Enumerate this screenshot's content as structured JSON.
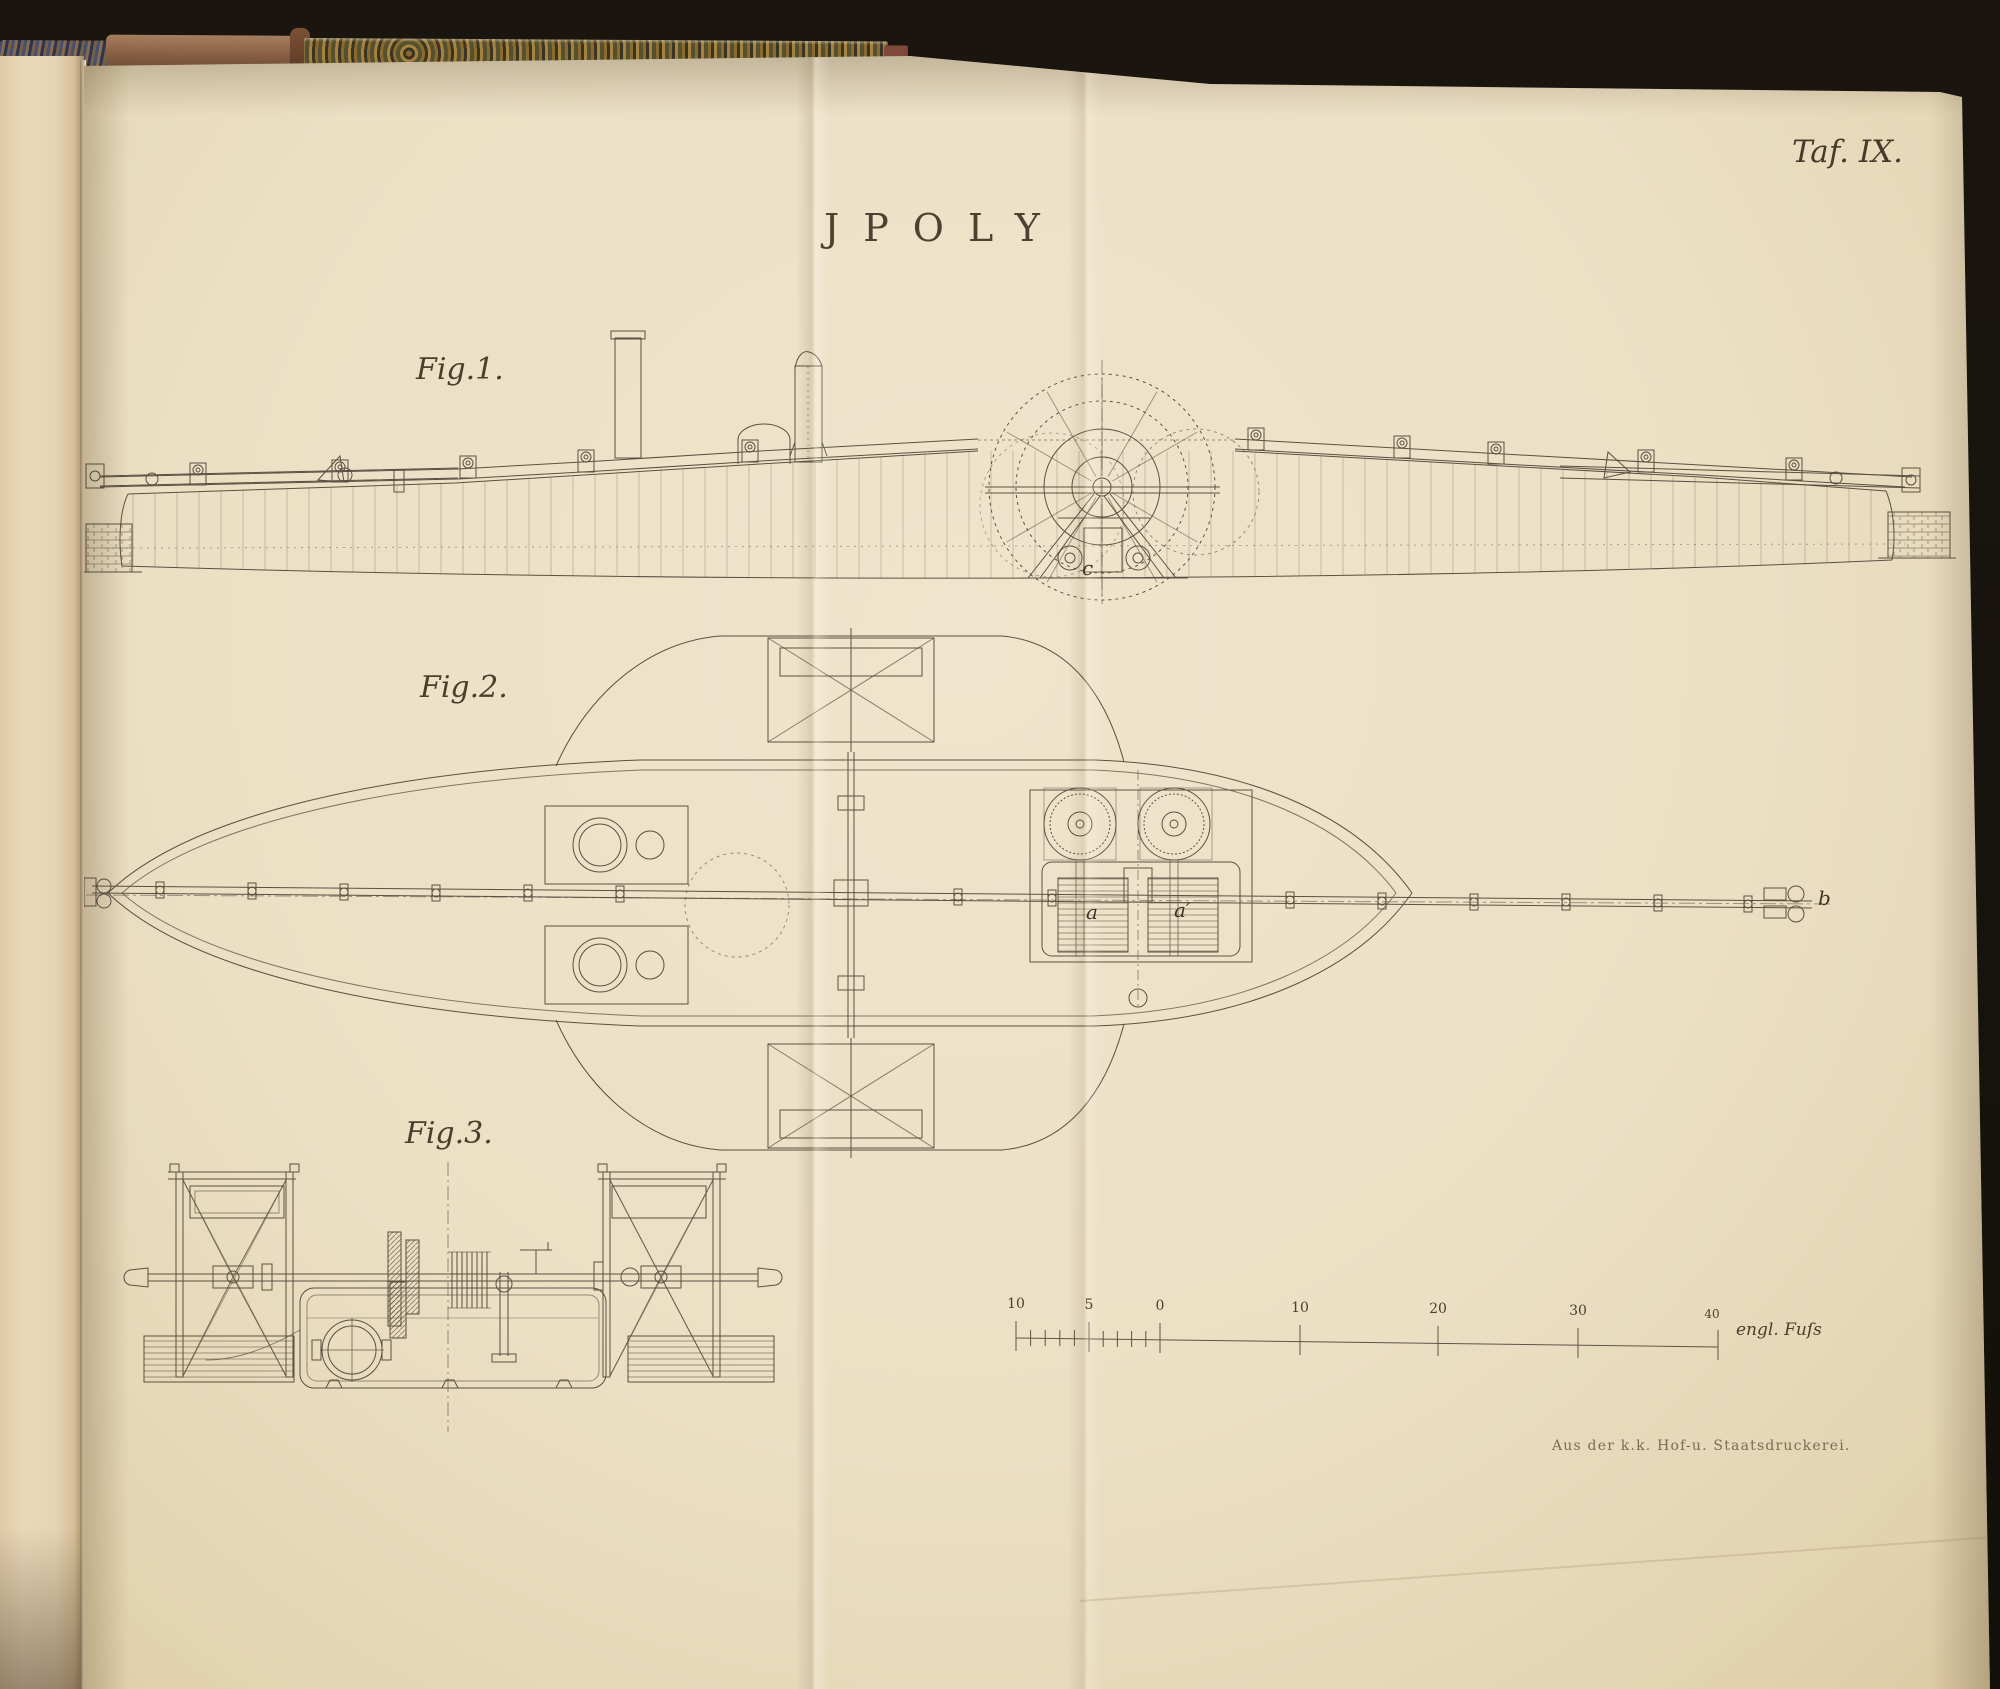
{
  "header": {
    "plate_number": "Taf. IX.",
    "title": "JPOLY"
  },
  "figures": [
    {
      "label": "Fig.1."
    },
    {
      "label": "Fig.2."
    },
    {
      "label": "Fig.3."
    }
  ],
  "part_labels": {
    "a": "a",
    "a_prime": "a′",
    "b": "b",
    "c": "c"
  },
  "scale_bar": {
    "tick_labels": [
      "10",
      "5",
      "0",
      "10",
      "20",
      "30",
      "40"
    ],
    "unit_label": "engl. Fuſs"
  },
  "imprint": "Aus der k.k. Hof-u. Staatsdruckerei.",
  "colors": {
    "paper": "#ebdfc4",
    "ink": "#473d2f",
    "background": "#16120d",
    "spine_leather": "#8a6247"
  }
}
